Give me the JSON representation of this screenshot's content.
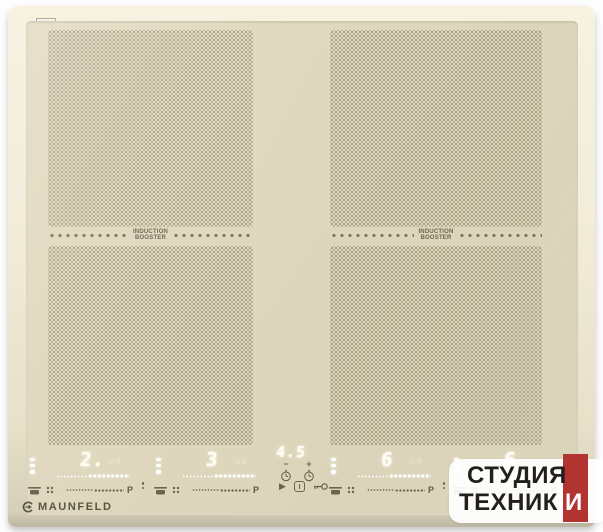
{
  "brand": {
    "name": "MAUNFELD"
  },
  "booster": {
    "line1": "INDUCTION",
    "line2": "BOOSTER"
  },
  "timer": {
    "display": "4.5",
    "minus": "−",
    "plus": "+"
  },
  "zones": [
    {
      "display": "2.",
      "secondary": "⊙8",
      "power_label": "P"
    },
    {
      "display": "3",
      "secondary": "⊙8",
      "power_label": "P"
    },
    {
      "display": "6",
      "secondary": "⊙8",
      "power_label": "P"
    },
    {
      "display": "6",
      "secondary": "",
      "power_label": "P"
    }
  ],
  "icons": {
    "play": "▶",
    "power": "I",
    "pan_detect": "pan",
    "bridge": "four-dot-grid",
    "key_lock": "key",
    "timer_clock": "clock",
    "zone_divider": "vertical-dots",
    "zone_select": "three-dots"
  },
  "watermark": {
    "line1": "СТУДИЯ",
    "line2": "ТЕХНИК",
    "accent_letter": "И"
  },
  "colors": {
    "background": "#ffffff",
    "frame": "#f1ebd8",
    "glass": "#ddd6bc",
    "glyph": "#6a644e",
    "led": "#fffdf2",
    "watermark_red": "#b23431",
    "watermark_text": "#221f1d"
  }
}
